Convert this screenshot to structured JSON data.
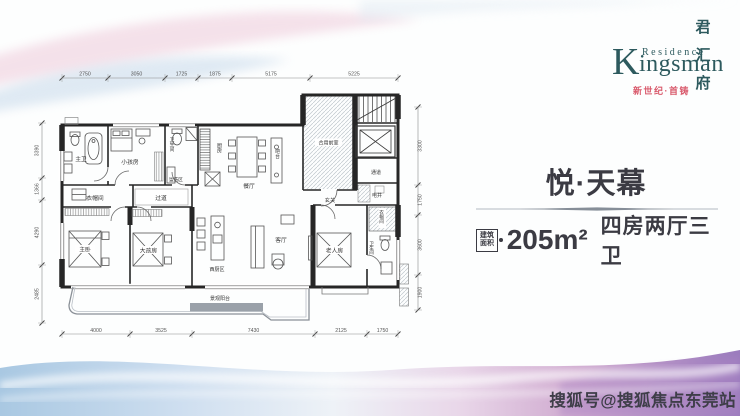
{
  "brand": {
    "initial": "K",
    "residence": "Residence",
    "rest": "ingsman",
    "vertical_name": [
      "君",
      "汇",
      "府"
    ],
    "tagline": "新世纪·首铸"
  },
  "unit": {
    "name": "悦·天幕",
    "area_badge": [
      "建筑",
      "面积"
    ],
    "area": "205m²",
    "rooms": "四房两厅三卫"
  },
  "watermark": "搜狐号@搜狐焦点东莞站",
  "floorplan": {
    "dims_top": [
      "2750",
      "3050",
      "1725",
      "1875",
      "5175",
      "5225"
    ],
    "dims_bottom": [
      "4000",
      "3525",
      "7430",
      "2125",
      "1750"
    ],
    "dims_left": [
      "3390",
      "1366",
      "4290",
      "2485"
    ],
    "dims_right": [
      "3300",
      "1750",
      "3600",
      "1900"
    ],
    "labels": {
      "master_bath": "主卫",
      "kids_room": "小孩房",
      "bathroom": "卫生间",
      "wash_area": "盥洗区",
      "kitchen": "厨房",
      "closet": "衣帽间",
      "corridor": "过道",
      "master_bedroom": "主卧",
      "teen_room": "大孩房",
      "dining": "餐厅",
      "bar": "吧台",
      "vestibule": "合用前室",
      "passage": "通道",
      "utility_shaft": "电井",
      "foyer": "玄关",
      "living": "客厅",
      "west_kitchen": "西厨区",
      "balcony": "景观阳台",
      "elder_room": "老人房",
      "elder_closet": "衣帽间",
      "elder_bath": "卫生间"
    }
  },
  "colors": {
    "brand": "#2d5a5e",
    "accent": "#d95a6c",
    "text": "#3b3b43"
  }
}
